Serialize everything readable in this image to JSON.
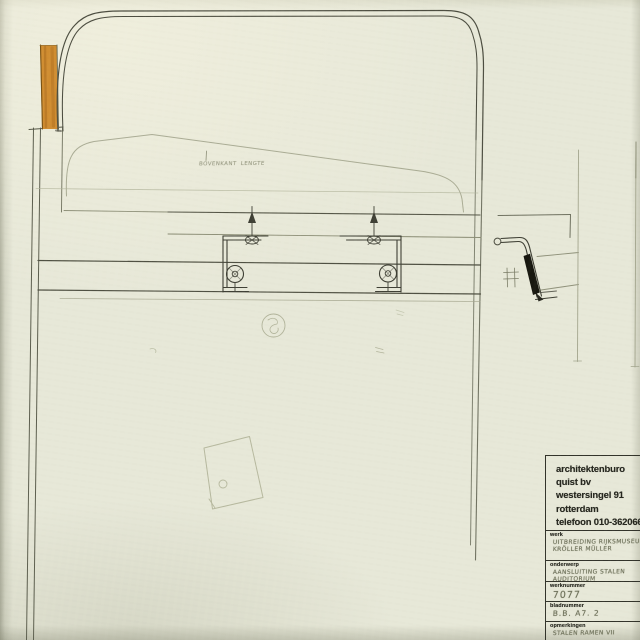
{
  "drawing": {
    "note_label": "bovenkant lengte"
  },
  "title_block": {
    "firm_lines": [
      "architektenburo",
      "quist bv",
      "westersingel 91",
      "rotterdam",
      "telefoon 010-362066"
    ],
    "fields": [
      {
        "label": "werk",
        "line1": "uitbreiding rijksmuseum",
        "line2": "kröller müller"
      },
      {
        "label": "onderwerp",
        "line1": "aansluiting stalen",
        "line2": "auditorium"
      },
      {
        "label": "werknummer",
        "line1": "7077",
        "line2": ""
      },
      {
        "label": "bladnummer",
        "line1": "B.B. A7. 2",
        "line2": ""
      },
      {
        "label": "opmerkingen",
        "line1": "stalen ramen VII",
        "line2": ""
      }
    ]
  },
  "colors": {
    "paper": "#e7e8d8",
    "ink": "#2b2b22",
    "pencil_faint": "#b2b49b",
    "pencil_dark": "#4c4d40",
    "wood_accent": "#d08d31",
    "steel_black": "#17170f"
  }
}
